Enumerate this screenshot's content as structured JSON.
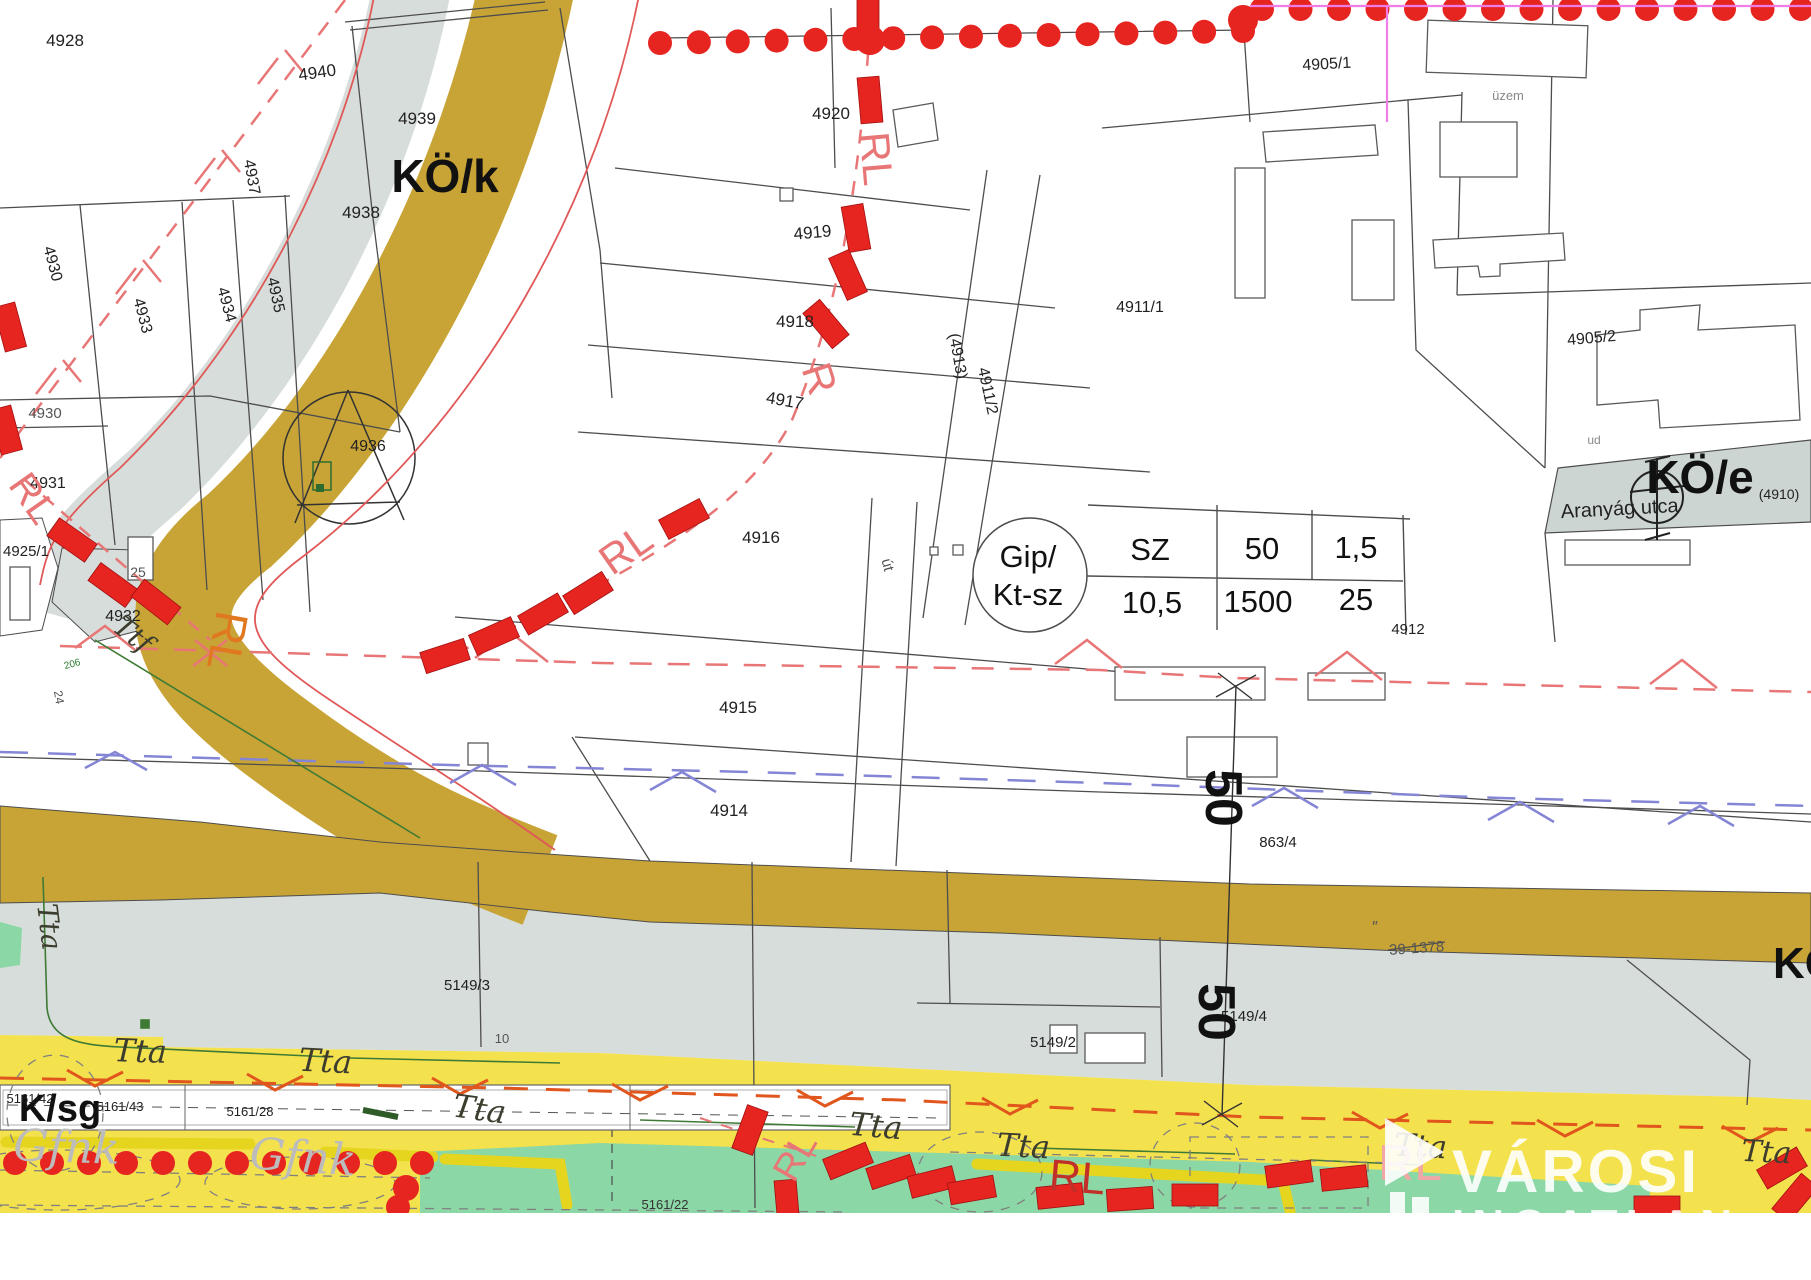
{
  "colors": {
    "road_olive": "#c8a436",
    "zone_gray": "#d7ddda",
    "street_gray": "#cdd5d2",
    "zone_yellow": "#f4e14e",
    "zone_green": "#8bd7a6",
    "reg_red": "#e62420",
    "reg_red_light": "#e87676",
    "orange_dash": "#e0561c",
    "blue_dash": "#8585d6",
    "magenta": "#f07ce8",
    "line_gray": "#4d4d4d",
    "logo_white": "#ffffff"
  },
  "table": {
    "circle_line1": "Gip/",
    "circle_line2": "Kt-sz",
    "rows": [
      [
        "SZ",
        "50",
        "1,5"
      ],
      [
        "10,5",
        "1500",
        "25"
      ]
    ]
  },
  "logo": {
    "title": "VÁROSI",
    "subtitle": "INGATLAN"
  },
  "labels": [
    {
      "id": "zone-ko-k",
      "text": "KÖ/k",
      "x": 445,
      "y": 192,
      "rot": 0,
      "size": 46,
      "color": "#111",
      "weight": "bold"
    },
    {
      "id": "zone-ko-e",
      "text": "KÖ/e",
      "x": 1700,
      "y": 493,
      "rot": 0,
      "size": 46,
      "color": "#111",
      "weight": "bold"
    },
    {
      "id": "zone-k-sg",
      "text": "K/sg",
      "x": 60,
      "y": 1121,
      "rot": 0,
      "size": 38,
      "color": "#111",
      "weight": "bold"
    },
    {
      "id": "zone-k-partial",
      "text": "KÖ",
      "x": 1806,
      "y": 978,
      "rot": 0,
      "size": 44,
      "color": "#111",
      "weight": "bold"
    },
    {
      "id": "parcel-4928",
      "text": "4928",
      "x": 65,
      "y": 46,
      "rot": 0,
      "size": 17
    },
    {
      "id": "parcel-4940",
      "text": "4940",
      "x": 318,
      "y": 78,
      "rot": -8,
      "size": 17
    },
    {
      "id": "parcel-4939",
      "text": "4939",
      "x": 417,
      "y": 124,
      "rot": 0,
      "size": 17
    },
    {
      "id": "parcel-4938",
      "text": "4938",
      "x": 361,
      "y": 218,
      "rot": 0,
      "size": 17
    },
    {
      "id": "parcel-4937",
      "text": "4937",
      "x": 247,
      "y": 178,
      "rot": 80,
      "size": 16
    },
    {
      "id": "parcel-4930-rot",
      "text": "4930",
      "x": 48,
      "y": 265,
      "rot": 75,
      "size": 16
    },
    {
      "id": "parcel-4933",
      "text": "4933",
      "x": 138,
      "y": 317,
      "rot": 75,
      "size": 16
    },
    {
      "id": "parcel-4934",
      "text": "4934",
      "x": 222,
      "y": 306,
      "rot": 75,
      "size": 16
    },
    {
      "id": "parcel-4935",
      "text": "4935",
      "x": 271,
      "y": 296,
      "rot": 78,
      "size": 16
    },
    {
      "id": "parcel-4930",
      "text": "4930",
      "x": 45,
      "y": 418,
      "rot": 0,
      "size": 15,
      "color": "#555"
    },
    {
      "id": "parcel-4931",
      "text": "4931",
      "x": 48,
      "y": 488,
      "rot": 0,
      "size": 16
    },
    {
      "id": "parcel-4925-1",
      "text": "4925/1",
      "x": 26,
      "y": 556,
      "rot": 0,
      "size": 15
    },
    {
      "id": "parcel-25",
      "text": "25",
      "x": 138,
      "y": 577,
      "rot": 0,
      "size": 14,
      "color": "#555"
    },
    {
      "id": "parcel-4932",
      "text": "4932",
      "x": 123,
      "y": 621,
      "rot": 0,
      "size": 16
    },
    {
      "id": "parcel-4936",
      "text": "4936",
      "x": 368,
      "y": 451,
      "rot": 0,
      "size": 16
    },
    {
      "id": "parcel-4920",
      "text": "4920",
      "x": 831,
      "y": 119,
      "rot": 0,
      "size": 17
    },
    {
      "id": "parcel-4919",
      "text": "4919",
      "x": 813,
      "y": 238,
      "rot": -5,
      "size": 17
    },
    {
      "id": "parcel-4918",
      "text": "4918",
      "x": 795,
      "y": 327,
      "rot": 0,
      "size": 17
    },
    {
      "id": "parcel-4917",
      "text": "4917",
      "x": 784,
      "y": 406,
      "rot": 10,
      "size": 17
    },
    {
      "id": "parcel-4916",
      "text": "4916",
      "x": 761,
      "y": 543,
      "rot": 0,
      "size": 17
    },
    {
      "id": "parcel-4915",
      "text": "4915",
      "x": 738,
      "y": 713,
      "rot": 0,
      "size": 17
    },
    {
      "id": "parcel-4914",
      "text": "4914",
      "x": 729,
      "y": 816,
      "rot": 0,
      "size": 17
    },
    {
      "id": "parcel-4913",
      "text": "(4913)",
      "x": 953,
      "y": 357,
      "rot": 80,
      "size": 16
    },
    {
      "id": "parcel-4911-2",
      "text": "4911/2",
      "x": 983,
      "y": 392,
      "rot": 78,
      "size": 16
    },
    {
      "id": "parcel-4911-1",
      "text": "4911/1",
      "x": 1140,
      "y": 312,
      "rot": 0,
      "size": 16
    },
    {
      "id": "parcel-4905-1",
      "text": "4905/1",
      "x": 1327,
      "y": 69,
      "rot": -3,
      "size": 16
    },
    {
      "id": "parcel-4905-2",
      "text": "4905/2",
      "x": 1592,
      "y": 343,
      "rot": -5,
      "size": 16
    },
    {
      "id": "parcel-4912",
      "text": "4912",
      "x": 1408,
      "y": 634,
      "rot": 0,
      "size": 15
    },
    {
      "id": "parcel-863-4",
      "text": "863/4",
      "x": 1278,
      "y": 847,
      "rot": 0,
      "size": 15
    },
    {
      "id": "parcel-5149-3",
      "text": "5149/3",
      "x": 467,
      "y": 990,
      "rot": 0,
      "size": 15
    },
    {
      "id": "parcel-10",
      "text": "10",
      "x": 502,
      "y": 1043,
      "rot": 0,
      "size": 13,
      "color": "#555"
    },
    {
      "id": "parcel-5149-2",
      "text": "5149/2",
      "x": 1053,
      "y": 1047,
      "rot": 0,
      "size": 15
    },
    {
      "id": "parcel-5149-4",
      "text": "5149/4",
      "x": 1244,
      "y": 1021,
      "rot": 0,
      "size": 15
    },
    {
      "id": "parcel-24",
      "text": "24",
      "x": 55,
      "y": 698,
      "rot": 80,
      "size": 12,
      "color": "#555"
    },
    {
      "id": "parcel-5161-42",
      "text": "5161/42",
      "x": 30,
      "y": 1103,
      "rot": 0,
      "size": 13
    },
    {
      "id": "parcel-5161-43",
      "text": "5161/43",
      "x": 120,
      "y": 1111,
      "rot": 0,
      "size": 13
    },
    {
      "id": "parcel-5161-28",
      "text": "5161/28",
      "x": 250,
      "y": 1116,
      "rot": 0,
      "size": 13
    },
    {
      "id": "parcel-5161-22",
      "text": "5161/22",
      "x": 665,
      "y": 1209,
      "rot": 0,
      "size": 13,
      "color": "#333"
    },
    {
      "id": "street-aranyag",
      "text": "Aranyág utca",
      "x": 1620,
      "y": 515,
      "rot": -3,
      "size": 20
    },
    {
      "id": "street-4910",
      "text": "(4910)",
      "x": 1779,
      "y": 499,
      "rot": 0,
      "size": 14
    },
    {
      "id": "street-ut",
      "text": "út",
      "x": 883,
      "y": 566,
      "rot": 75,
      "size": 15,
      "color": "#555"
    },
    {
      "id": "note-uzem",
      "text": "üzem",
      "x": 1508,
      "y": 100,
      "rot": 0,
      "size": 13,
      "color": "#888"
    },
    {
      "id": "note-ud",
      "text": "ud",
      "x": 1594,
      "y": 444,
      "rot": 0,
      "size": 12,
      "color": "#888"
    },
    {
      "id": "note-39-1378",
      "text": "39-1378",
      "x": 1417,
      "y": 953,
      "rot": -4,
      "size": 15,
      "color": "#555"
    },
    {
      "id": "note-quote",
      "text": "″",
      "x": 1375,
      "y": 932,
      "rot": 0,
      "size": 16,
      "color": "#555"
    },
    {
      "id": "note-206",
      "text": "206",
      "x": 73,
      "y": 667,
      "rot": -15,
      "size": 10,
      "color": "#2e7d32"
    },
    {
      "id": "dim-50-top",
      "text": "50",
      "x": 1206,
      "y": 798,
      "rot": 90,
      "size": 52,
      "color": "#111",
      "weight": "600"
    },
    {
      "id": "dim-50-bottom",
      "text": "50",
      "x": 1199,
      "y": 1012,
      "rot": 90,
      "size": 52,
      "color": "#111",
      "weight": "600"
    },
    {
      "id": "tta-1",
      "text": "Tta",
      "x": 140,
      "y": 1062,
      "rot": 2,
      "size": 32,
      "color": "#3d3d2f",
      "script": true
    },
    {
      "id": "tta-2",
      "text": "Tta",
      "x": 325,
      "y": 1072,
      "rot": 3,
      "size": 32,
      "color": "#3d3d2f",
      "script": true
    },
    {
      "id": "tta-3",
      "text": "Tta",
      "x": 478,
      "y": 1120,
      "rot": 8,
      "size": 32,
      "color": "#3d3d2f",
      "script": true
    },
    {
      "id": "tta-4",
      "text": "Tta",
      "x": 875,
      "y": 1137,
      "rot": 5,
      "size": 32,
      "color": "#3d3d2f",
      "script": true
    },
    {
      "id": "tta-5",
      "text": "Tta",
      "x": 1023,
      "y": 1157,
      "rot": 3,
      "size": 32,
      "color": "#3d3d2f",
      "script": true
    },
    {
      "id": "tta-6",
      "text": "Tta",
      "x": 1420,
      "y": 1157,
      "rot": 3,
      "size": 32,
      "color": "#3d3d2f",
      "script": true
    },
    {
      "id": "tta-7",
      "text": "Tta",
      "x": 1766,
      "y": 1162,
      "rot": 3,
      "size": 30,
      "color": "#3d3d2f",
      "script": true
    },
    {
      "id": "tta-v",
      "text": "Tta",
      "x": 40,
      "y": 928,
      "rot": 83,
      "size": 28,
      "color": "#3d3d2f",
      "script": true
    },
    {
      "id": "ttf",
      "text": "Ttf",
      "x": 127,
      "y": 642,
      "rot": 38,
      "size": 28,
      "color": "#3d3d2f",
      "script": true
    },
    {
      "id": "gfnk-1",
      "text": "Gfnk",
      "x": 66,
      "y": 1162,
      "rot": 2,
      "size": 44,
      "color": "#bcbcbc",
      "script": true
    },
    {
      "id": "gfnk-2",
      "text": "Gfnk",
      "x": 302,
      "y": 1172,
      "rot": 4,
      "size": 44,
      "color": "#bcbcbc",
      "script": true
    },
    {
      "id": "rl-1",
      "text": "RL",
      "x": 862,
      "y": 160,
      "rot": 85,
      "size": 42,
      "color": "#e87676"
    },
    {
      "id": "rl-2",
      "text": "R",
      "x": 806,
      "y": 383,
      "rot": 72,
      "size": 42,
      "color": "#e87676"
    },
    {
      "id": "rl-3",
      "text": "RL",
      "x": 634,
      "y": 561,
      "rot": -35,
      "size": 42,
      "color": "#e87676"
    },
    {
      "id": "rl-4",
      "text": "RL",
      "x": 22,
      "y": 506,
      "rot": 55,
      "size": 40,
      "color": "#e87676"
    },
    {
      "id": "rl-5",
      "text": "RL",
      "x": 806,
      "y": 1163,
      "rot": -60,
      "size": 38,
      "color": "#e87676"
    },
    {
      "id": "rl-orange",
      "text": "RL",
      "x": 212,
      "y": 638,
      "rot": 100,
      "size": 46,
      "color": "#e07820"
    },
    {
      "id": "rl-6",
      "text": "RL",
      "x": 1076,
      "y": 1192,
      "rot": 5,
      "size": 44,
      "color": "#c03028"
    },
    {
      "id": "rl-7",
      "text": "RL",
      "x": 1410,
      "y": 1180,
      "rot": 0,
      "size": 50,
      "color": "#f2a7a7"
    }
  ]
}
